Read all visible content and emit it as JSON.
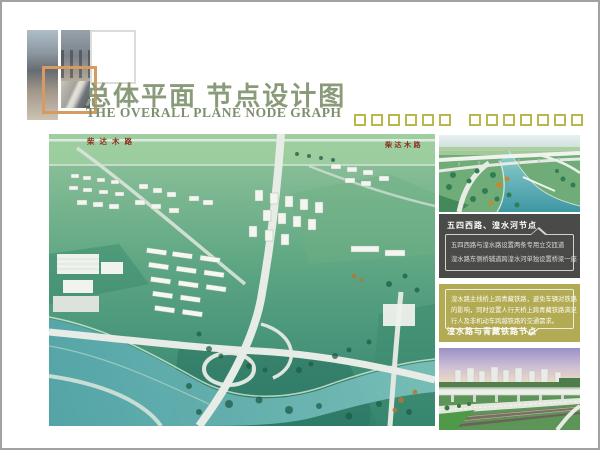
{
  "header": {
    "title": "总体平面 节点设计图",
    "subtitle": "THE OVERALL PLANE NODE GRAPH"
  },
  "logo": {
    "pieces": [
      "bridge-photo-strip",
      "bridge-pier-photo",
      "empty-outline-square",
      "orange-outline-square",
      "ramp-photo"
    ]
  },
  "decor": {
    "hollow_squares_group1": 6,
    "hollow_squares_group2": 7,
    "square_outline_color": "#b9b74e"
  },
  "main_image": {
    "description": "鸟瞰效果图（总体平面）",
    "labels": {
      "top_left_road": "柴达木路",
      "top_right_road": "柴达木路"
    }
  },
  "sidebar": {
    "node1": {
      "title": "五四西路、湟水河节点",
      "line1": "五四西路与湟水路设置两条专用立交匝道",
      "line2": "湟水路东侧桥辅道跨湟水河单独设置桥梁一座"
    },
    "node2": {
      "line1": "湟水路主线桥上跨青藏铁路，避免车辆对铁路",
      "line2": "的影响，同时设置人行天桥上跨青藏铁路满足",
      "line3": "行人及非机动车跨越铁路的交通需求。",
      "title": "湟水路与青藏铁路节点"
    }
  },
  "colors": {
    "title_green": "#8a9b7a",
    "decor_square_olive": "#b9b74e",
    "panel_dark": "#4a4a48",
    "panel_olive": "#b2ab54",
    "logo_orange": "#d79b62",
    "road_label_red": "#8b2f1f",
    "page_border_gray": "#a2a2a2"
  }
}
